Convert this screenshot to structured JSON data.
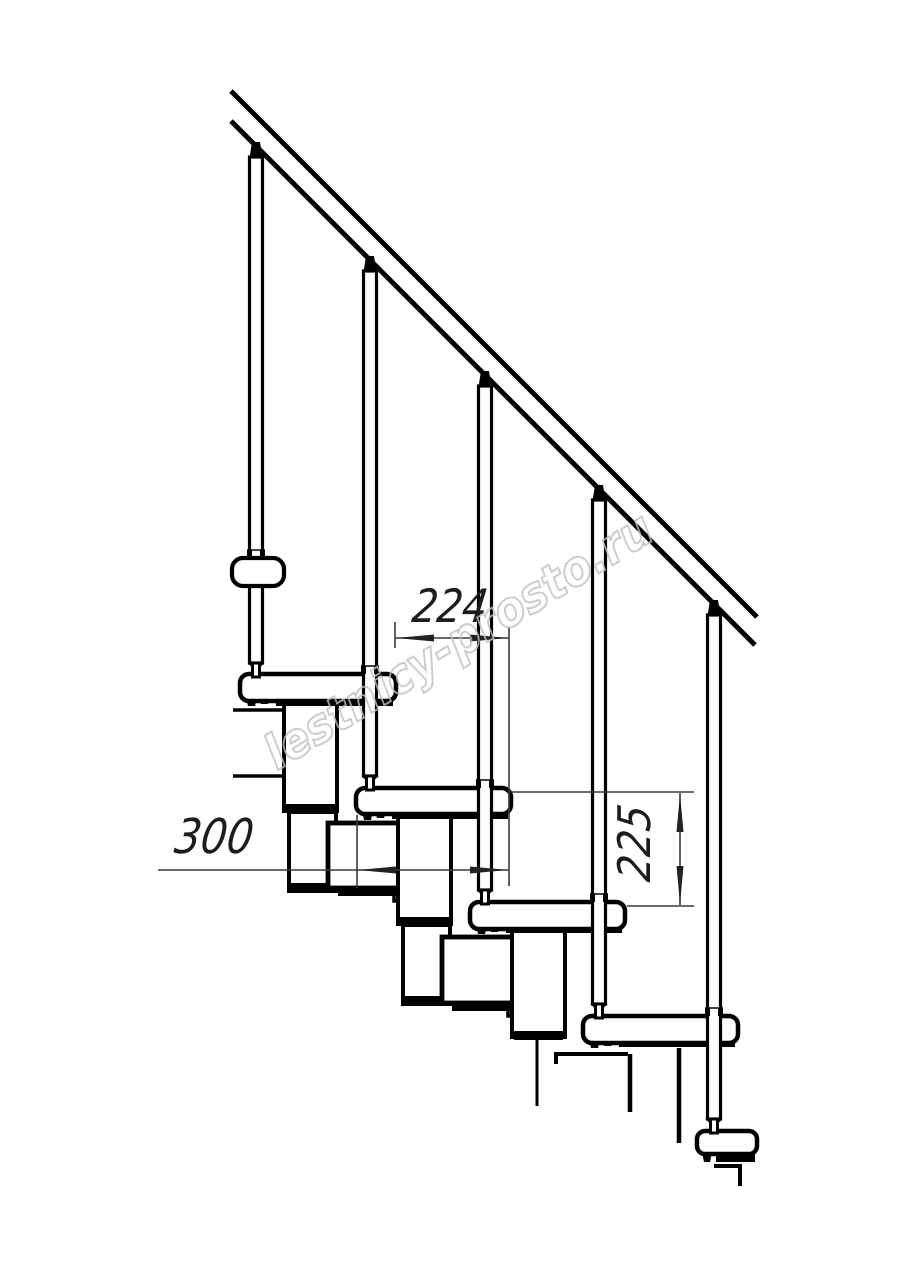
{
  "drawing": {
    "type": "staircase-side-elevation",
    "dimensions": {
      "run": {
        "value": "224",
        "orientation": "horizontal"
      },
      "width": {
        "value": "300",
        "orientation": "horizontal"
      },
      "rise": {
        "value": "225",
        "orientation": "vertical"
      }
    },
    "watermark": {
      "text": "lestnicy-prosto.ru"
    },
    "colors": {
      "line": "#000000",
      "dimension": "#3a3a3a",
      "watermark": "#c0c0c0",
      "background": "#ffffff"
    }
  }
}
